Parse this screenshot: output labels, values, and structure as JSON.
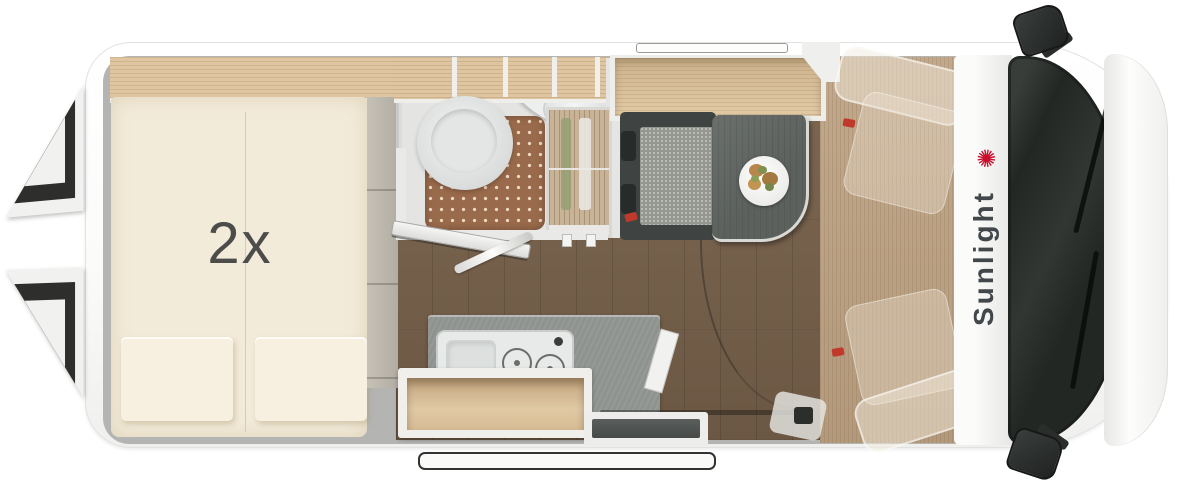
{
  "floorplan": {
    "bed": {
      "label": "2x"
    },
    "brand": {
      "name": "Sunlight",
      "palm_icon": "✺"
    }
  },
  "colors": {
    "body_white": "#fbfbfa",
    "wall_gray": "#b4b5b3",
    "mattress_cream": "#f3ebd9",
    "pillow_cream": "#f7f0e1",
    "oak_light": "#dfc5a0",
    "oak_rim": "#efeeea",
    "floor_brown": "#7e6853",
    "floor_brown_dark": "#6b5743",
    "cab_floor_tan": "#c2a98c",
    "bath_floor": "#dcdddb",
    "shower_mat": "#996a4b",
    "mat_dot": "#eed9c2",
    "wardrobe_wood": "#b69a74",
    "counter_gray": "#8f938f",
    "unit_white": "#e8eae9",
    "table_gray": "#5c615e",
    "bench_frame": "#3f4442",
    "bench_cushion": "#94968f",
    "step_dark": "#454947",
    "windshield_dark": "#232724",
    "mirror_dark": "#2a2d2b",
    "accent_red": "#c0392b",
    "brand_red": "#c8102e",
    "label_dark": "#4c4c4a",
    "partition_taupe": "#b2ada3"
  }
}
